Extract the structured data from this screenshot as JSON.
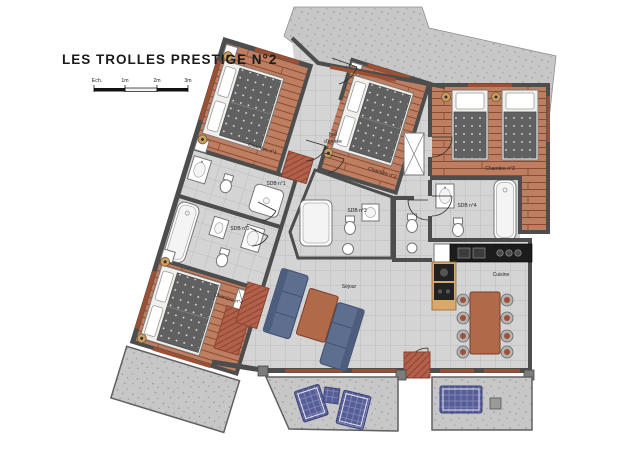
{
  "title": "LES TROLLES PRESTIGE N°2",
  "scale_bar": {
    "label": "Ech.",
    "m1": "1m",
    "m2": "2m",
    "m3": "3m"
  },
  "rooms": {
    "chambre1": "Chambre n°1",
    "chambre2": "Chambre n°2",
    "chambre3": "Chambre n°3",
    "chambre4": "Chambre n°4",
    "sdb1": "SDB n°1",
    "sdb2": "SDB n°2",
    "sdb3": "SDB n°3",
    "sdb4": "SDB n°4",
    "hall_line1": "hall",
    "hall_line2": "d'entrée",
    "sejour": "Séjour",
    "cuisine": "Cuisine"
  },
  "colors": {
    "wall": "#4d4d4d",
    "window": "#9c4f33",
    "wood_base": "#bd7e61",
    "wood_line": "#8a4b31",
    "tile_base": "#d4d4d4",
    "tile_line": "#bcbcbc",
    "concrete": "#c7c7c7",
    "bed": "#616161",
    "rug": "#b2604a",
    "sofa": "#5d6e8e",
    "outdoor": "#575d96",
    "counter": "#1c1c1c",
    "cabinet": "#d9a96b",
    "table": "#b06a4a"
  }
}
